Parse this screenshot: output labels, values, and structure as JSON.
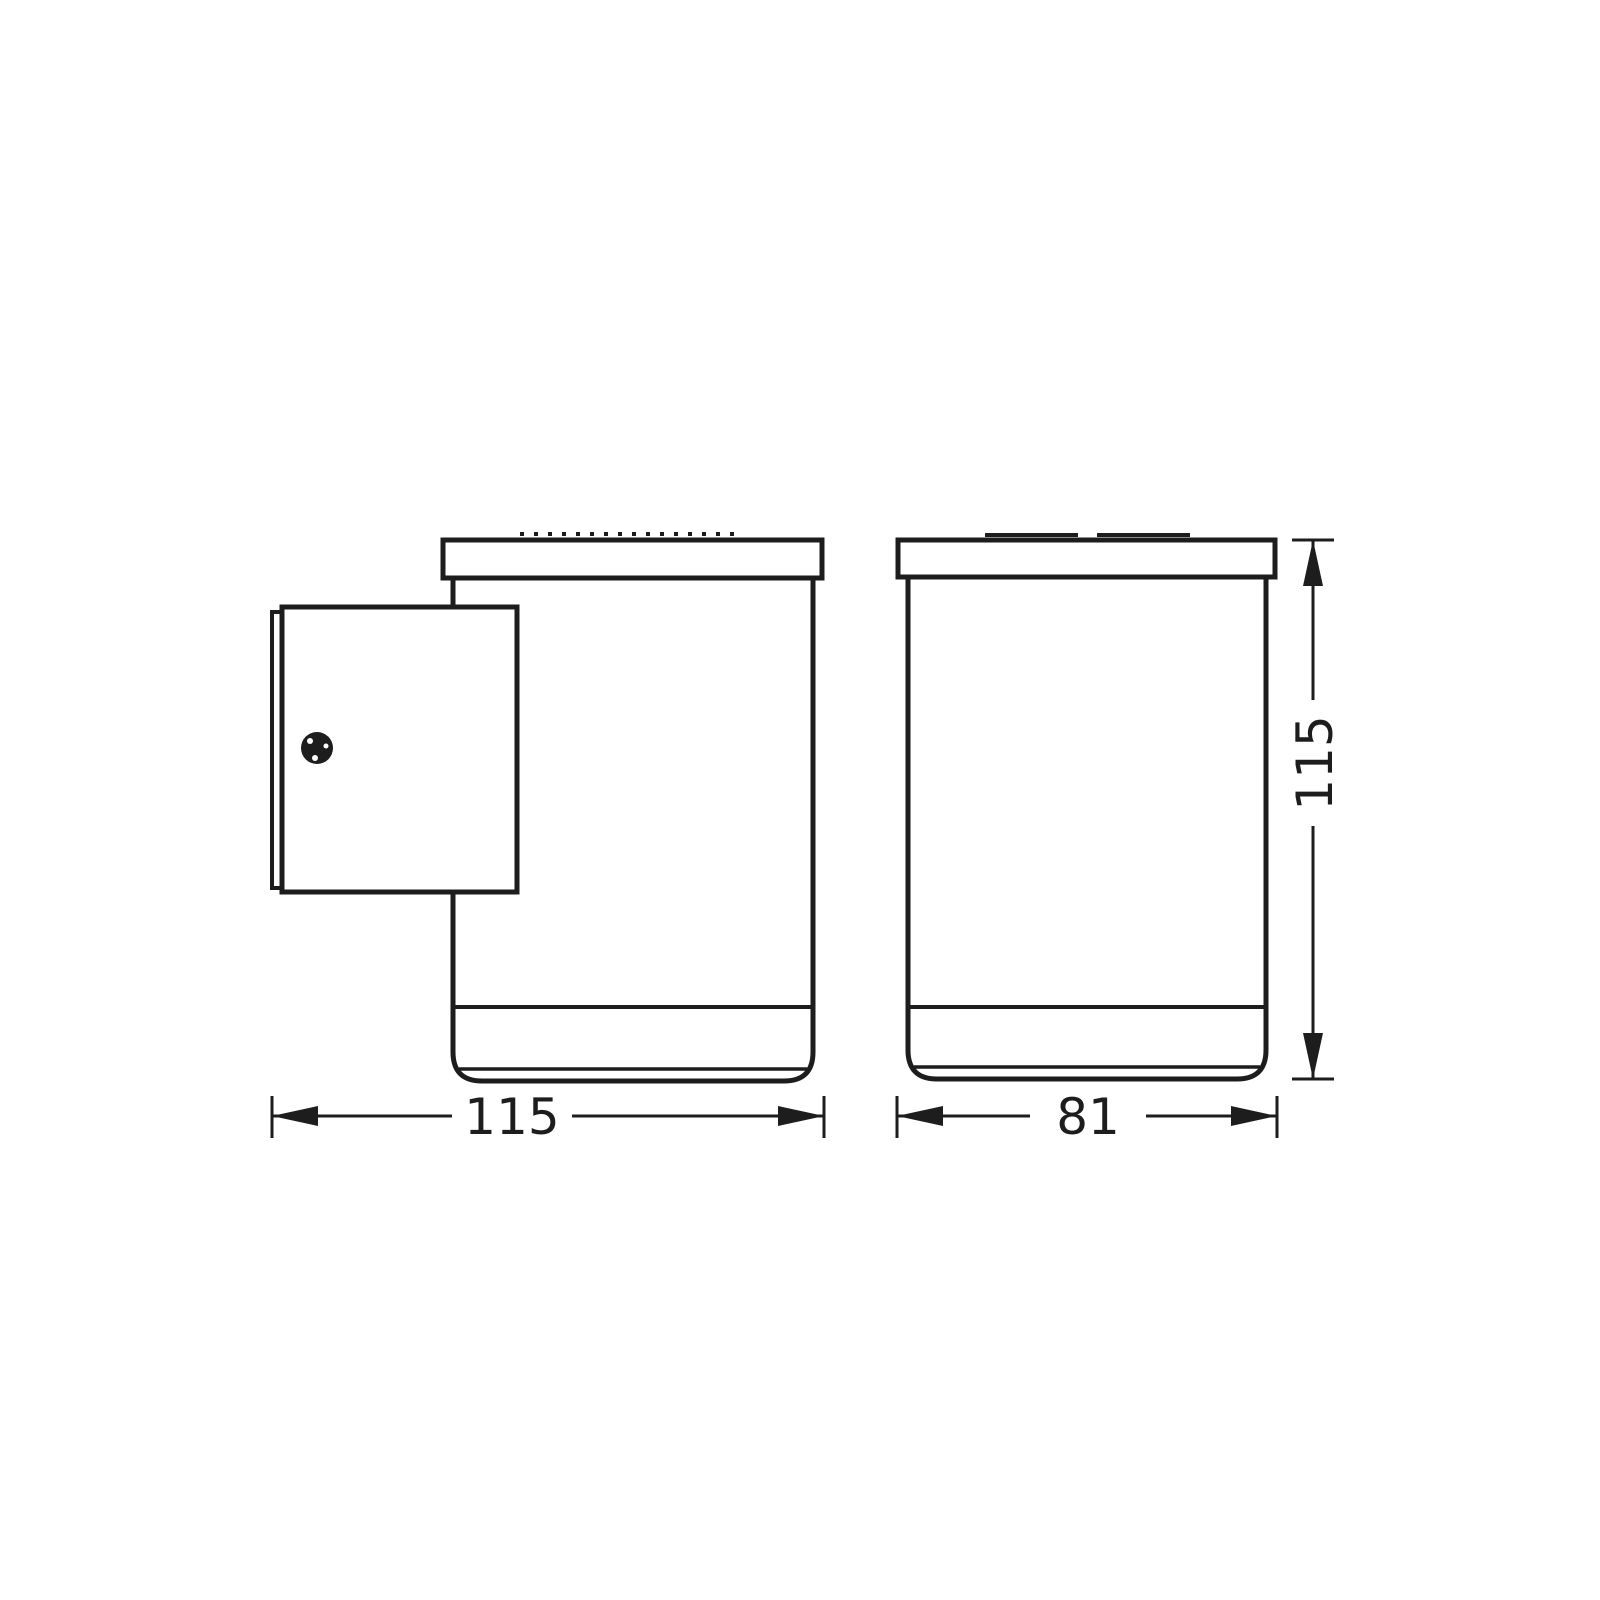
{
  "page": {
    "background_color": "#ffffff"
  },
  "drawing": {
    "line_color": "#1d1d1d",
    "views": {
      "side_view": {
        "id": "side-view-with-wall-plate"
      },
      "front_view": {
        "id": "front-view"
      }
    },
    "dimensions": {
      "side_view_width": "115",
      "front_view_width": "81",
      "height": "115"
    }
  }
}
